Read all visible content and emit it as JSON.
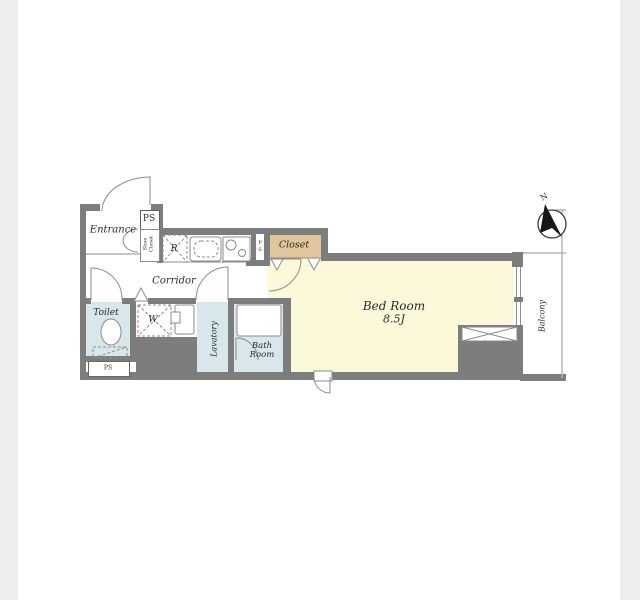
{
  "colors": {
    "wall": "#7d7d7d",
    "wet_area_fill": "#d7e7ea",
    "bedroom_fill": "#fbf9da",
    "closet_fill": "#e1c59b",
    "band": "#ededed",
    "line": "#8b8b8b",
    "text": "#2b2b2b",
    "needle": "#161616"
  },
  "rooms": {
    "entrance": "Entrance",
    "corridor": "Corridor",
    "toilet": "Toilet",
    "lavatory": "Lavatory",
    "bath_room": "Bath Room",
    "closet": "Closet",
    "shoe_closet": "Shoe Closet",
    "bed_room": "Bed Room",
    "bed_room_size": "8.5J",
    "balcony": "Balcony"
  },
  "fixtures": {
    "refrigerator": "R",
    "washer": "W"
  },
  "service": {
    "ps_entrance": "PS",
    "ps_kitchen": "PS",
    "ps_toilet": "PS"
  },
  "compass": {
    "north": "N"
  }
}
